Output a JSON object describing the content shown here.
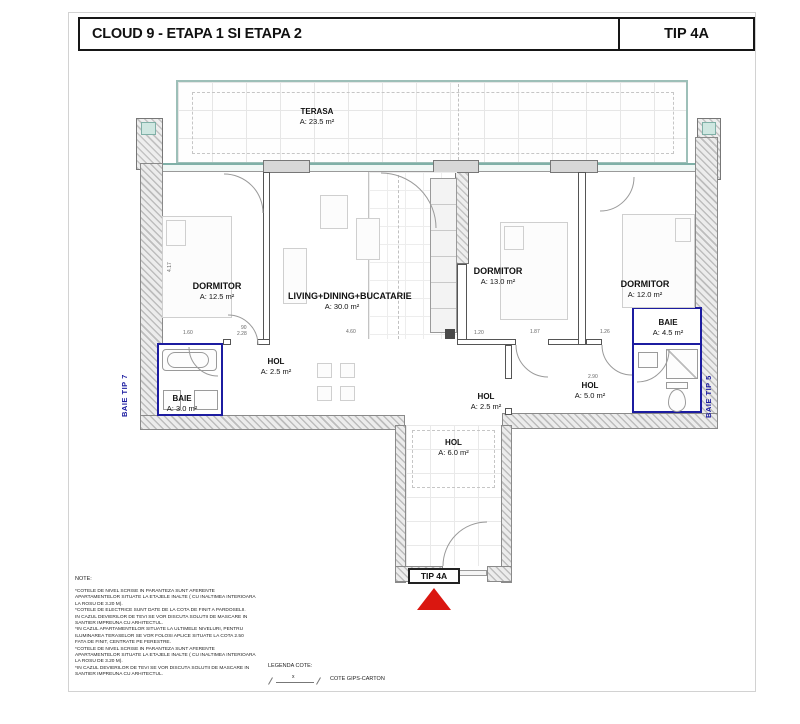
{
  "sheet": {
    "project_title": "CLOUD 9 - ETAPA 1 SI ETAPA 2",
    "type_label": "TIP 4A"
  },
  "rooms": {
    "terasa": {
      "name": "TERASA",
      "area": "A: 23.5 m²"
    },
    "dormitor1": {
      "name": "DORMITOR",
      "area": "A: 12.5 m²"
    },
    "living": {
      "name": "LIVING+DINING+BUCATARIE",
      "area": "A: 30.0 m²"
    },
    "dormitor2": {
      "name": "DORMITOR",
      "area": "A: 13.0 m²"
    },
    "dormitor3": {
      "name": "DORMITOR",
      "area": "A: 12.0 m²"
    },
    "baie1": {
      "name": "BAIE",
      "area": "A: 3.0 m²"
    },
    "baie2": {
      "name": "BAIE",
      "area": "A: 4.5 m²"
    },
    "hol1": {
      "name": "HOL",
      "area": "A: 2.5 m²"
    },
    "hol2": {
      "name": "HOL",
      "area": "A: 2.5 m²"
    },
    "hol3": {
      "name": "HOL",
      "area": "A: 5.0 m²"
    },
    "hol4": {
      "name": "HOL",
      "area": "A: 6.0 m²"
    }
  },
  "side_labels": {
    "left": "BAIE TIP 7",
    "right": "BAIE TIP 5"
  },
  "entrance": {
    "type_label": "TIP 4A"
  },
  "dims": [
    "1.60",
    "90",
    "2.28",
    "4.60",
    "1.20",
    "1.87",
    "1.26",
    "2.90",
    "4.17"
  ],
  "note": {
    "title": "NOTE:",
    "body": "*COTELE DE NIVEL SCRISE IN PARANTEZA SUNT AFERENTE\nAPARTAMENTELOR SITUATE LA ETAJELE INALTE ( CU INALTIMEA INTERIOARA\nLA ROSU DE 3.20 M).\n*COTELE DE ELECTRICE SUNT DATE DE LA COTA DE FINIT A PARDOSELII.\nIN CAZUL DEVIERILOR DE TEVI SE VOR DISCUTA SOLUTII DE MASCARE IN\nSANTIER IMPREUNA CU ARHITECTUL.\n*IN CAZUL APARTAMENTELOR SITUATE LA ULTIMELE NIVELURI, PENTRU\nILUMINAREA TERASELOR SE VOR FOLOSI APLICE SITUATE LA COTA 2.50\nFATA DE FINIT, CENTRATE PE FERESTRE.\n*COTELE DE NIVEL SCRISE IN PARANTEZA SUNT AFERENTE\nAPARTAMENTELOR SITUATE LA ETAJELE INALTE ( CU INALTIMEA INTERIOARA\nLA ROSU DE 3.20 M).\n*IN CAZUL DEVIERILOR DE TEVI SE VOR DISCUTA SOLUTII DE MASCARE IN\nSANTIER IMPREUNA CU ARHITECTUL."
  },
  "legend": {
    "title": "LEGENDA COTE:",
    "symbol_label": "x",
    "item": "COTE GIPS-CARTON"
  },
  "colors": {
    "partition_blue": "#1c1ca0",
    "entrance_red": "#da1710",
    "glass_teal": "#cfe7e1",
    "wall_hatch_gray": "#bdbdbd"
  }
}
